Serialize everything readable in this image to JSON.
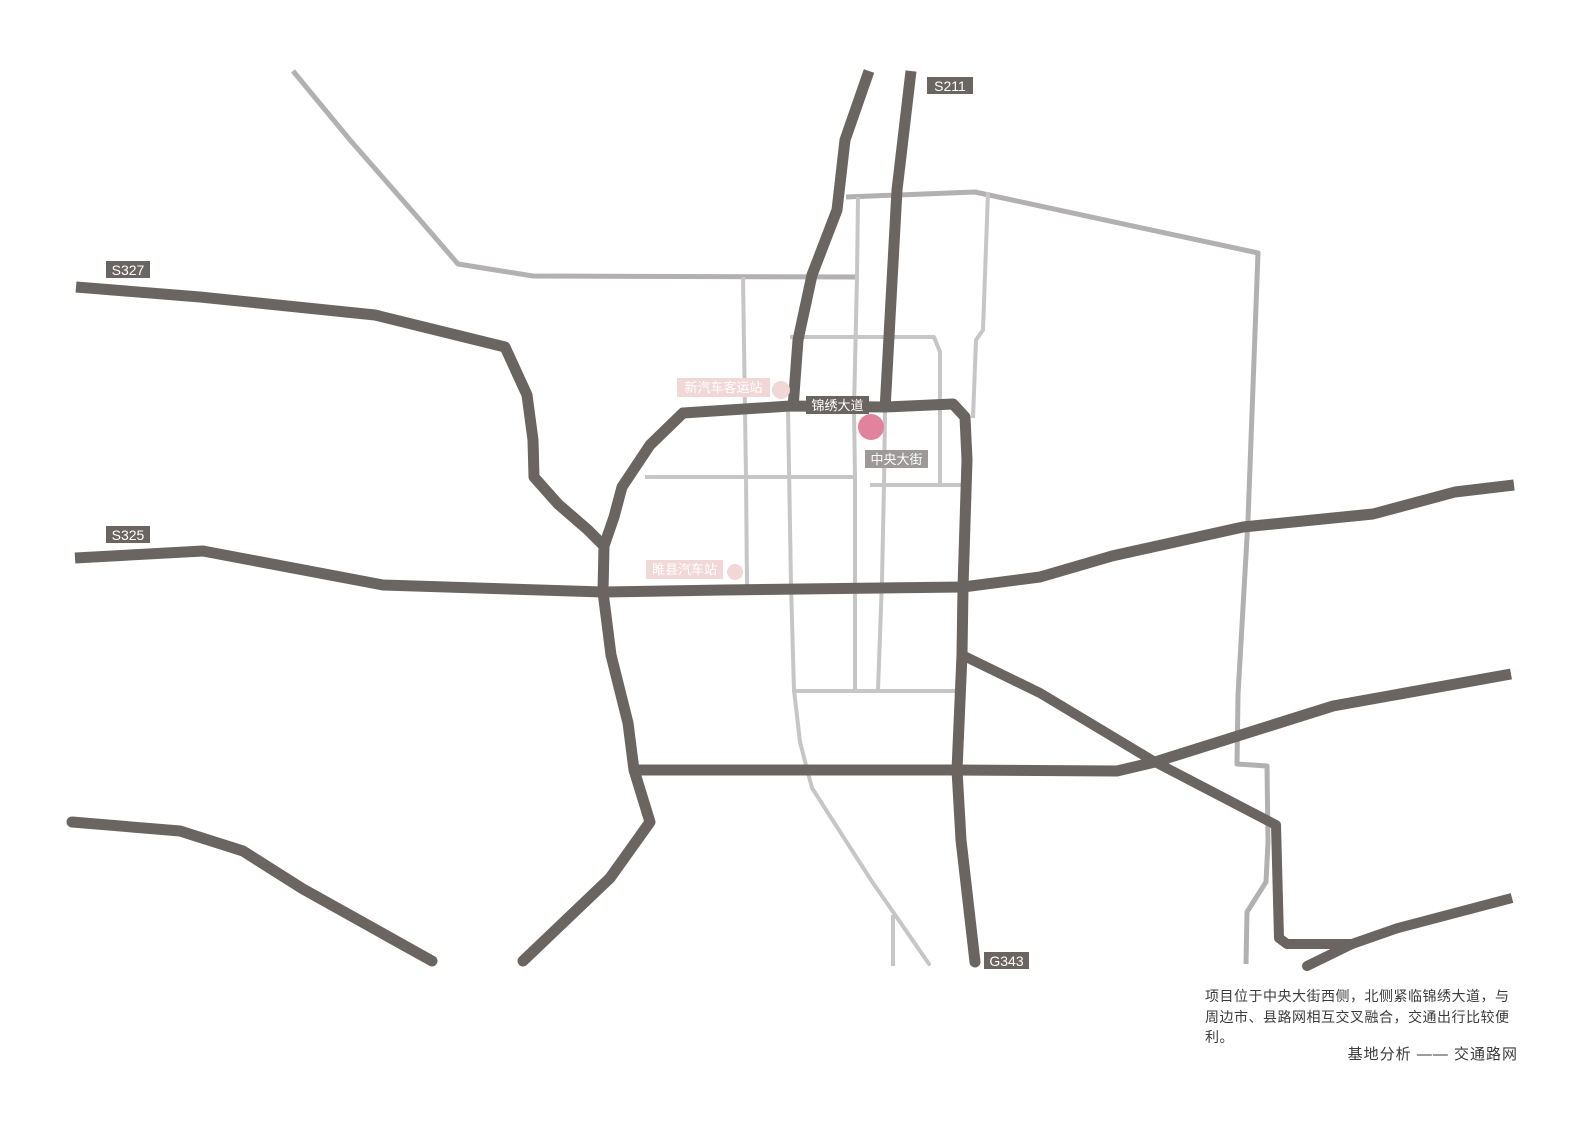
{
  "map": {
    "colors": {
      "background": "#ffffff",
      "major_road": "#6b6561",
      "mid_road": "#b2b0b0",
      "minor_road": "#c7c5c5",
      "site_marker": "#e2839d",
      "station_pink": "#f1d8d6",
      "label_dark_bg": "#6b6561",
      "label_gray_bg": "#9c9998",
      "text_dark": "#3b3b3b"
    },
    "roads": [
      {
        "id": "nw-rural-road",
        "tier": "mid",
        "width": 5,
        "cap": "butt",
        "points": [
          [
            293,
            71
          ],
          [
            350,
            140
          ],
          [
            420,
            220
          ],
          [
            458,
            264
          ],
          [
            533,
            276
          ],
          [
            858,
            277
          ]
        ]
      },
      {
        "id": "north-east-boundary",
        "tier": "mid",
        "width": 5,
        "cap": "butt",
        "points": [
          [
            846,
            197
          ],
          [
            975,
            192
          ],
          [
            1258,
            253
          ],
          [
            1248,
            520
          ],
          [
            1238,
            695
          ],
          [
            1237,
            764
          ],
          [
            1267,
            766
          ],
          [
            1268,
            842
          ],
          [
            1266,
            882
          ],
          [
            1247,
            912
          ],
          [
            1246,
            964
          ]
        ]
      },
      {
        "id": "boundary-west-vertical",
        "tier": "minor",
        "width": 4,
        "cap": "butt",
        "points": [
          [
            858,
            197
          ],
          [
            857,
            277
          ],
          [
            854,
            410
          ],
          [
            855,
            477
          ],
          [
            855,
            690
          ]
        ]
      },
      {
        "id": "boundary-inner-vertical",
        "tier": "minor",
        "width": 4,
        "cap": "butt",
        "points": [
          [
            988,
            192
          ],
          [
            983,
            330
          ],
          [
            976,
            340
          ],
          [
            973,
            418
          ]
        ]
      },
      {
        "id": "grid-vertical-west",
        "tier": "minor",
        "width": 4,
        "cap": "butt",
        "points": [
          [
            743,
            277
          ],
          [
            746,
            477
          ],
          [
            747,
            585
          ]
        ]
      },
      {
        "id": "grid-vertical-center",
        "tier": "minor",
        "width": 4,
        "cap": "round",
        "points": [
          [
            788,
            410
          ],
          [
            791,
            585
          ],
          [
            794,
            690
          ],
          [
            800,
            742
          ],
          [
            812,
            788
          ],
          [
            871,
            880
          ],
          [
            929,
            964
          ]
        ]
      },
      {
        "id": "grid-vertical-zhongyang",
        "tier": "minor",
        "width": 4,
        "cap": "butt",
        "points": [
          [
            885,
            410
          ],
          [
            884,
            485
          ],
          [
            882,
            580
          ],
          [
            878,
            690
          ]
        ]
      },
      {
        "id": "grid-elbow-north",
        "tier": "minor",
        "width": 4,
        "cap": "butt",
        "points": [
          [
            790,
            337
          ],
          [
            934,
            337
          ],
          [
            940,
            352
          ],
          [
            940,
            485
          ]
        ]
      },
      {
        "id": "grid-horizontal-west",
        "tier": "minor",
        "width": 4,
        "cap": "butt",
        "points": [
          [
            645,
            477
          ],
          [
            856,
            477
          ]
        ]
      },
      {
        "id": "grid-horizontal-east",
        "tier": "minor",
        "width": 4,
        "cap": "butt",
        "points": [
          [
            870,
            485
          ],
          [
            962,
            485
          ]
        ]
      },
      {
        "id": "grid-horizontal-south",
        "tier": "minor",
        "width": 4,
        "cap": "butt",
        "points": [
          [
            792,
            691
          ],
          [
            955,
            691
          ]
        ]
      },
      {
        "id": "grid-vertical-bottom",
        "tier": "minor",
        "width": 4,
        "cap": "butt",
        "points": [
          [
            893,
            915
          ],
          [
            893,
            966
          ]
        ]
      },
      {
        "id": "s211-west-branch",
        "tier": "major",
        "width": 11,
        "cap": "butt",
        "points": [
          [
            869,
            71
          ],
          [
            845,
            140
          ],
          [
            837,
            210
          ],
          [
            812,
            275
          ],
          [
            798,
            340
          ],
          [
            793,
            408
          ]
        ]
      },
      {
        "id": "s211-east-branch",
        "tier": "major",
        "width": 11,
        "cap": "butt",
        "points": [
          [
            911,
            71
          ],
          [
            897,
            190
          ],
          [
            891,
            300
          ],
          [
            885,
            410
          ]
        ]
      },
      {
        "id": "jinxiu-avenue-east-ring-g343",
        "tier": "major",
        "width": 11,
        "cap": "round",
        "points": [
          [
            683,
            413
          ],
          [
            790,
            406
          ],
          [
            885,
            407
          ],
          [
            953,
            404
          ],
          [
            965,
            417
          ],
          [
            967,
            460
          ],
          [
            963,
            587
          ],
          [
            962,
            655
          ],
          [
            957,
            770
          ],
          [
            961,
            840
          ],
          [
            975,
            962
          ]
        ]
      },
      {
        "id": "west-ring",
        "tier": "major",
        "width": 11,
        "cap": "round",
        "points": [
          [
            683,
            413
          ],
          [
            650,
            445
          ],
          [
            622,
            487
          ],
          [
            614,
            517
          ],
          [
            604,
            546
          ],
          [
            603,
            592
          ],
          [
            611,
            655
          ],
          [
            628,
            723
          ],
          [
            634,
            770
          ],
          [
            650,
            822
          ],
          [
            610,
            878
          ],
          [
            523,
            961
          ]
        ]
      },
      {
        "id": "s327-road",
        "tier": "major",
        "width": 11,
        "cap": "butt",
        "points": [
          [
            76,
            287
          ],
          [
            200,
            297
          ],
          [
            375,
            315
          ],
          [
            505,
            347
          ],
          [
            527,
            395
          ],
          [
            533,
            440
          ],
          [
            534,
            477
          ],
          [
            558,
            504
          ],
          [
            588,
            530
          ],
          [
            604,
            546
          ]
        ]
      },
      {
        "id": "s325-central-road",
        "tier": "major",
        "width": 11,
        "cap": "butt",
        "points": [
          [
            75,
            558
          ],
          [
            203,
            551
          ],
          [
            383,
            585
          ],
          [
            603,
            592
          ],
          [
            723,
            590
          ],
          [
            963,
            587
          ],
          [
            1040,
            577
          ],
          [
            1112,
            556
          ],
          [
            1243,
            527
          ],
          [
            1373,
            514
          ],
          [
            1455,
            492
          ],
          [
            1514,
            485
          ]
        ]
      },
      {
        "id": "southeast-diagonal",
        "tier": "major",
        "width": 10,
        "cap": "butt",
        "points": [
          [
            962,
            655
          ],
          [
            1040,
            693
          ],
          [
            1155,
            762
          ],
          [
            1276,
            825
          ],
          [
            1279,
            938
          ],
          [
            1287,
            944
          ],
          [
            1352,
            944
          ],
          [
            1398,
            928
          ],
          [
            1512,
            898
          ]
        ]
      },
      {
        "id": "southeast-spur",
        "tier": "major",
        "width": 10,
        "cap": "round",
        "points": [
          [
            1352,
            944
          ],
          [
            1307,
            966
          ]
        ]
      },
      {
        "id": "south-road",
        "tier": "major",
        "width": 11,
        "cap": "butt",
        "points": [
          [
            634,
            770
          ],
          [
            950,
            770
          ],
          [
            1117,
            771
          ],
          [
            1155,
            762
          ],
          [
            1333,
            706
          ],
          [
            1511,
            674
          ]
        ]
      },
      {
        "id": "southwest-road",
        "tier": "major",
        "width": 11,
        "cap": "round",
        "points": [
          [
            72,
            822
          ],
          [
            180,
            831
          ],
          [
            243,
            851
          ],
          [
            303,
            889
          ],
          [
            432,
            961
          ]
        ]
      }
    ],
    "road_labels": [
      {
        "id": "s211",
        "label": "S211",
        "x": 927,
        "y": 77,
        "w": 46,
        "h": 17,
        "bg": "#6b6561",
        "color": "#ffffff",
        "fs": 14
      },
      {
        "id": "s327",
        "label": "S327",
        "x": 106,
        "y": 261,
        "w": 44,
        "h": 17,
        "bg": "#6b6561",
        "color": "#ffffff",
        "fs": 14
      },
      {
        "id": "s325",
        "label": "S325",
        "x": 106,
        "y": 526,
        "w": 44,
        "h": 17,
        "bg": "#6b6561",
        "color": "#ffffff",
        "fs": 14
      },
      {
        "id": "g343",
        "label": "G343",
        "x": 984,
        "y": 952,
        "w": 45,
        "h": 17,
        "bg": "#6b6561",
        "color": "#ffffff",
        "fs": 14
      },
      {
        "id": "jinxiu-avenue",
        "label": "锦绣大道",
        "x": 806,
        "y": 396,
        "w": 63,
        "h": 18,
        "bg": "#6b6561",
        "color": "#ffffff",
        "fs": 13
      },
      {
        "id": "zhongyang-street",
        "label": "中央大街",
        "x": 865,
        "y": 450,
        "w": 63,
        "h": 18,
        "bg": "#9c9998",
        "color": "#ffffff",
        "fs": 13
      },
      {
        "id": "new-bus-terminal",
        "label": "新汽车客运站",
        "x": 677,
        "y": 378,
        "w": 93,
        "h": 19,
        "bg": "#f1d8d6",
        "color": "#ffffff",
        "fs": 13
      },
      {
        "id": "suixian-bus-station",
        "label": "睢县汽车站",
        "x": 646,
        "y": 560,
        "w": 77,
        "h": 19,
        "bg": "#f1d8d6",
        "color": "#ffffff",
        "fs": 13
      }
    ],
    "markers": [
      {
        "id": "new-bus-terminal-dot",
        "cx": 781,
        "cy": 390,
        "r": 9,
        "color": "#f1d8d6"
      },
      {
        "id": "suixian-bus-station-dot",
        "cx": 735,
        "cy": 572,
        "r": 8,
        "color": "#f1d8d6"
      },
      {
        "id": "project-site-dot",
        "cx": 871,
        "cy": 427,
        "r": 13,
        "color": "#e2839d"
      }
    ]
  },
  "caption": {
    "line1": "项目位于中央大街西侧，北侧紧临锦绣大道，与",
    "line2": "周边市、县路网相互交叉融合，交通出行比较便利。"
  },
  "footer": {
    "title": "基地分析 —— 交通路网"
  }
}
